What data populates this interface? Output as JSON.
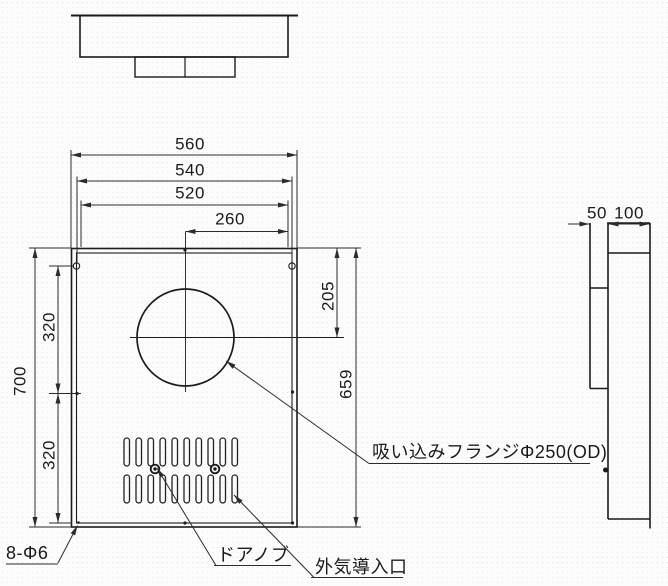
{
  "drawing": {
    "title": "wall ventilation chamber dimensional drawing",
    "colors": {
      "line": "#1b1b1b",
      "dim": "#2b2b2b",
      "background": "#fdfcfd"
    },
    "dims": {
      "w560": "560",
      "w540": "540",
      "w520": "520",
      "w260": "260",
      "h700": "700",
      "p320_upper": "320",
      "p320_lower": "320",
      "h205": "205",
      "h659": "659",
      "d50": "50",
      "d100": "100"
    },
    "callouts": {
      "holes": "8-Φ6",
      "door_knob": "ドアノブ",
      "air_inlet": "外気導入口",
      "suction_flange": "吸い込みフランジΦ250(OD)"
    }
  }
}
